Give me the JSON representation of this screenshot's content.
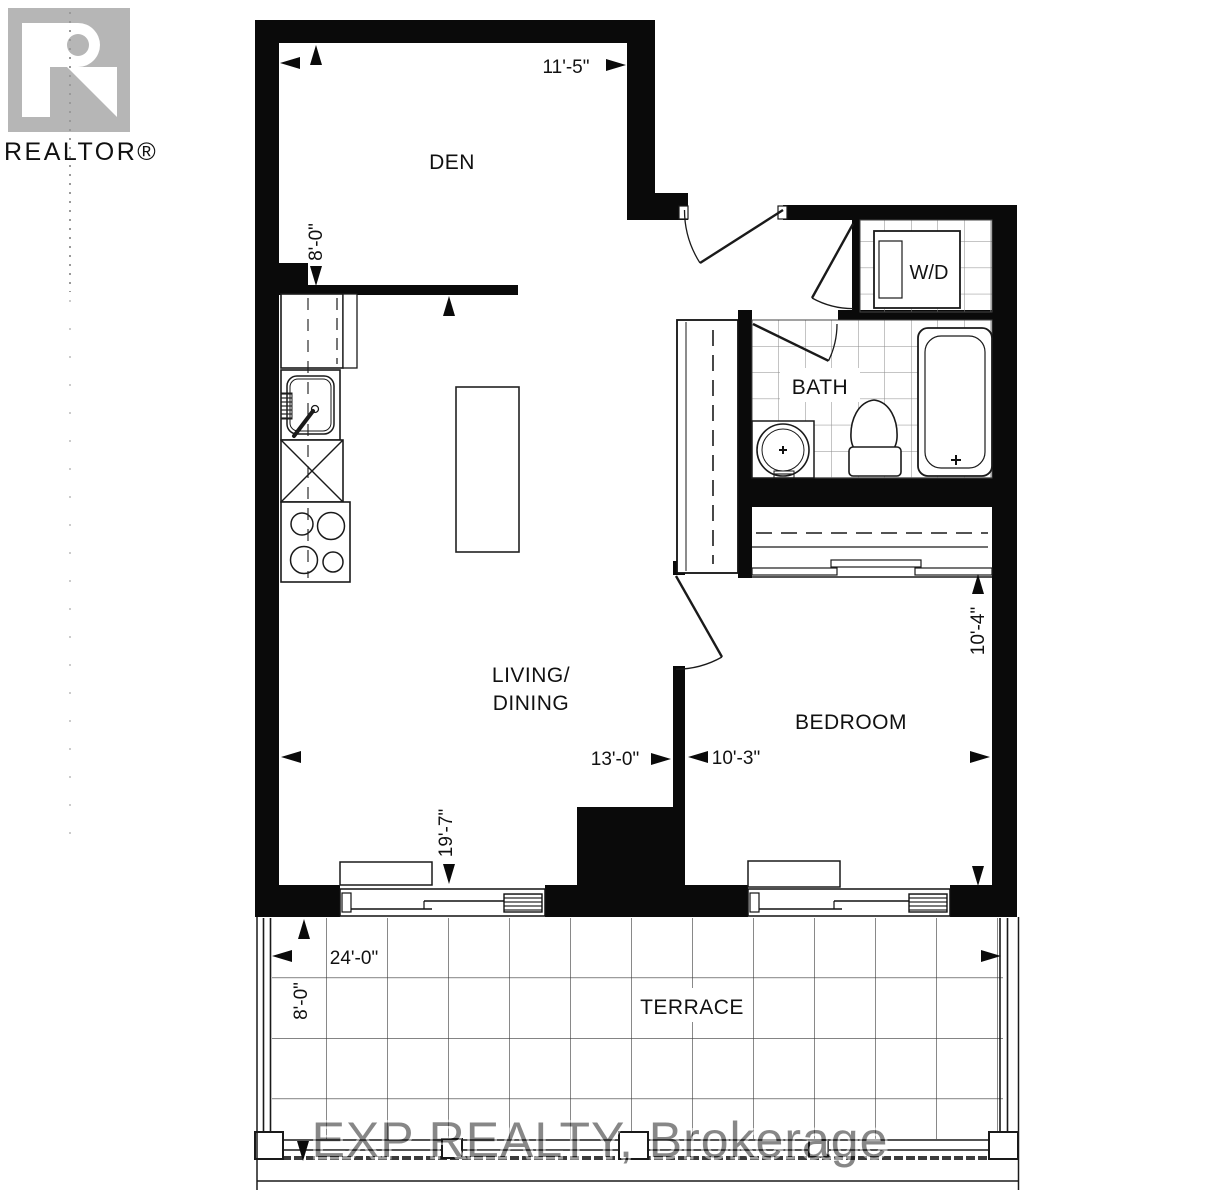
{
  "branding": {
    "logo_text": "REALTOR®",
    "watermark": "EXP REALTY, Brokerage"
  },
  "rooms": {
    "den": {
      "label": "DEN"
    },
    "living": {
      "line1": "LIVING/",
      "line2": "DINING"
    },
    "bedroom": {
      "label": "BEDROOM"
    },
    "bath": {
      "label": "BATH"
    },
    "laundry": {
      "label": "W/D"
    },
    "terrace": {
      "label": "TERRACE"
    }
  },
  "dims": {
    "den_width": "11'-5\"",
    "den_depth": "8'-0\"",
    "living_width": "13'-0\"",
    "living_depth": "19'-7\"",
    "bedroom_width": "10'-3\"",
    "bedroom_depth": "10'-4\"",
    "terrace_width": "24'-0\"",
    "terrace_depth": "8'-0\""
  },
  "colors": {
    "wall": "#0a0a0a",
    "line": "#1a1a1a",
    "tile": "#787878",
    "logo": "#b6b6b6",
    "watermark": "#a9a9a9"
  }
}
